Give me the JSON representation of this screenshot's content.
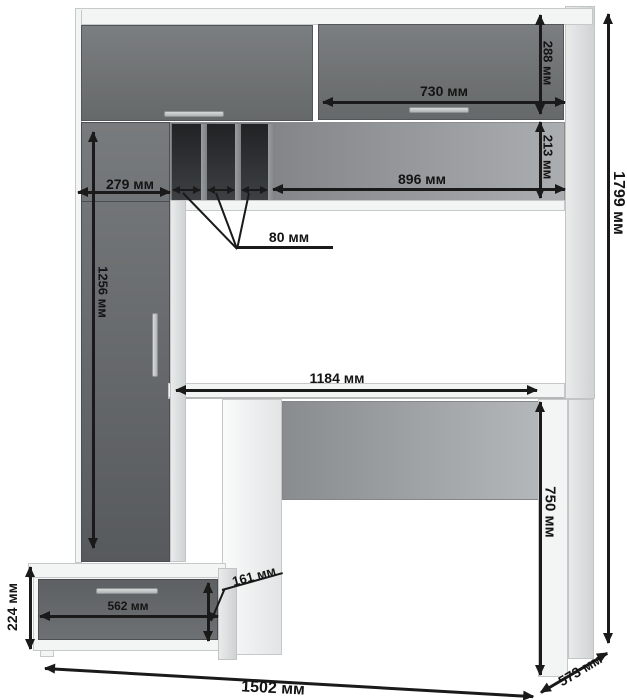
{
  "drawing": {
    "type": "furniture-dimension-diagram",
    "subject": "computer desk with hutch, tall cabinet and drawer pedestal",
    "unit": "мм"
  },
  "colors": {
    "front_gray": "#6b6e70",
    "panel_white": "#f3f4f4",
    "slot_dark": "#2b2e30",
    "dim_line": "#1a1a1a"
  },
  "dims": {
    "d288": {
      "label": "288 мм",
      "mm": 288,
      "meaning": "top right door height"
    },
    "d730": {
      "label": "730 мм",
      "mm": 730,
      "meaning": "top right door width"
    },
    "d213": {
      "label": "213 мм",
      "mm": 213,
      "meaning": "open shelf height"
    },
    "d896": {
      "label": "896 мм",
      "mm": 896,
      "meaning": "open shelf width"
    },
    "d279": {
      "label": "279 мм",
      "mm": 279,
      "meaning": "tall cabinet width"
    },
    "d80": {
      "label": "80 мм",
      "mm": 80,
      "meaning": "pigeonhole slot width"
    },
    "d1256": {
      "label": "1256 мм",
      "mm": 1256,
      "meaning": "tall cabinet door height"
    },
    "d1184": {
      "label": "1184 мм",
      "mm": 1184,
      "meaning": "desktop width"
    },
    "d1799": {
      "label": "1799 мм",
      "mm": 1799,
      "meaning": "overall height"
    },
    "d750": {
      "label": "750 мм",
      "mm": 750,
      "meaning": "desk height"
    },
    "d161": {
      "label": "161 мм",
      "mm": 161,
      "meaning": "drawer front height"
    },
    "d562": {
      "label": "562 мм",
      "mm": 562,
      "meaning": "drawer width"
    },
    "d224": {
      "label": "224 мм",
      "mm": 224,
      "meaning": "pedestal height"
    },
    "d1502": {
      "label": "1502 мм",
      "mm": 1502,
      "meaning": "overall width"
    },
    "d573": {
      "label": "573 мм",
      "mm": 573,
      "meaning": "overall depth"
    }
  }
}
